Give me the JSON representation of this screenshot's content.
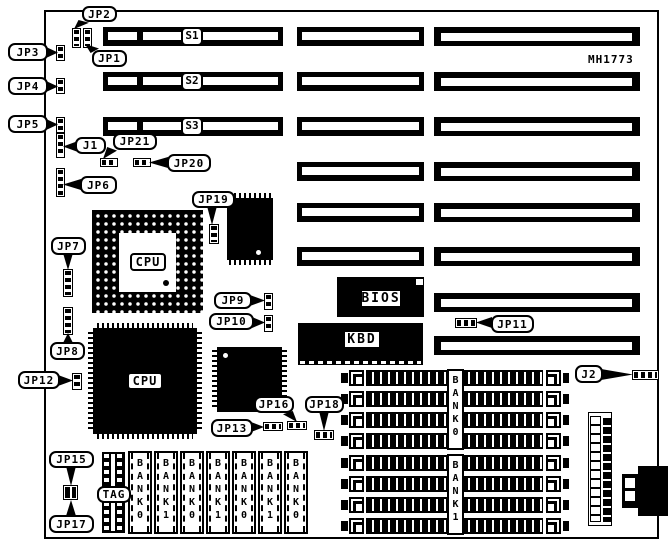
{
  "board": {
    "part_number": "MH1773",
    "slots": {
      "s1": "S1",
      "s2": "S2",
      "s3": "S3"
    },
    "chips": {
      "cpu_socket": "CPU",
      "cpu": "CPU",
      "bios": "BIOS",
      "kbd": "KBD",
      "tag": "TAG"
    },
    "jumpers": {
      "jp1": "JP1",
      "jp2": "JP2",
      "jp3": "JP3",
      "jp4": "JP4",
      "jp5": "JP5",
      "jp6": "JP6",
      "jp7": "JP7",
      "jp8": "JP8",
      "jp9": "JP9",
      "jp10": "JP10",
      "jp11": "JP11",
      "jp12": "JP12",
      "jp13": "JP13",
      "jp15": "JP15",
      "jp16": "JP16",
      "jp17": "JP17",
      "jp18": "JP18",
      "jp19": "JP19",
      "jp20": "JP20",
      "jp21": "JP21",
      "j1": "J1",
      "j2": "J2"
    },
    "memory": {
      "sram_banks": [
        "BANK0",
        "BANK1",
        "BANK0",
        "BANK1",
        "BANK0",
        "BANK1",
        "BANK0"
      ],
      "simm_banks": [
        "BANK0",
        "BANK1"
      ]
    }
  }
}
